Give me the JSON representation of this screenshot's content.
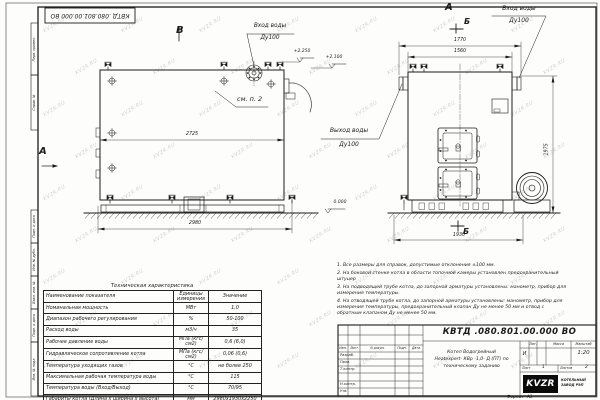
{
  "watermark": {
    "text": "KVZR.RU"
  },
  "corner_stamp": {
    "text": "КВТД .080.801.00.000  ВО"
  },
  "margin_labels": [
    "Перв. примен.",
    "Справ. №",
    "Подп. и дата",
    "Инв. № дубл.",
    "Взам. инв. №",
    "Подп. и дата",
    "Инв. № подл."
  ],
  "drawing": {
    "view_labels": {
      "v_side": "В",
      "v_front": "А",
      "section_top": "Б",
      "section_bottom": "Б",
      "arrow_left": "А"
    },
    "labels": {
      "inlet_left_1": "Вход воды",
      "inlet_left_2": "Ду100",
      "inlet_right_1": "Вход воды",
      "inlet_right_2": "Ду100",
      "outlet_1": "Выход воды",
      "outlet_2": "Ду100",
      "see_note": "см. п. 2"
    },
    "dimensions": {
      "side_body_length": "2725",
      "side_overall_length": "2980",
      "front_overall_width": "1770",
      "front_body_width": "1560",
      "front_height": "1975",
      "front_base_width": "1930"
    },
    "elevations": {
      "top": "+2.250",
      "mid": "+2.100",
      "ground": "0.000"
    }
  },
  "notes": {
    "items": [
      "1. Все размеры для справок, допустимые отклонения ±100 мм.",
      "2. На боковой стенке котла в области топочной камеры установлен предохранительный штуцер",
      "3. На подводящей трубе котла, до запорной арматуры установлены: манометр, прибор для измерения температуры.",
      "4. На отводящей трубе котла, до запорной арматуры установлены: манометр, прибор для измерения температуры, предохранительный клапан Ду не менее 50 мм и отвод с обратным клапаном Ду не менее 50 мм."
    ]
  },
  "tech_table": {
    "title": "Техническая характеристика",
    "headers": {
      "name": "Наименование показателя",
      "units": "Единицы\nизмерения",
      "value": "Значение"
    },
    "rows": [
      {
        "name": "Номинальная мощность",
        "units": "МВт",
        "value": "1,0"
      },
      {
        "name": "Диапазон рабочего регулирования",
        "units": "%",
        "value": "50-100"
      },
      {
        "name": "Расход воды",
        "units": "м3/ч",
        "value": "35"
      },
      {
        "name": "Рабочее давление воды",
        "units": "МПа (кгс/см2)",
        "value": "0,6 (6,0)"
      },
      {
        "name": "Гидравлическое сопротивление котла",
        "units": "МПа (кгс/см2)",
        "value": "0,06 (0,6)"
      },
      {
        "name": "Температура уходящих газов",
        "units": "°С",
        "value": "не более 250"
      },
      {
        "name": "Максимальная рабочая температура воды",
        "units": "°С",
        "value": "115"
      },
      {
        "name": "Температура воды (Вход/Выход)",
        "units": "°С",
        "value": "70/95"
      },
      {
        "name": "Габариты котла (Длина х ширина х высота)",
        "units": "мм",
        "value": "2980х1930х2250"
      }
    ]
  },
  "title_block": {
    "doc_number": "КВТД .080.801.00.000  ВО",
    "name_line1": "Котел Водогрейный",
    "name_line2": "Heatexpert- КВр -1,0- Д (ПТ) по",
    "name_line3": "техническому заданию",
    "col_izm": "Изм.",
    "col_list": "Лист",
    "col_doc": "N докум.",
    "col_podp": "Подп.",
    "col_data": "Дата",
    "roles": [
      "Разраб.",
      "Пров.",
      "Т.контр.",
      "Н.контр.",
      "Утв."
    ],
    "lit_label": "Лит.",
    "mass_label": "Масса",
    "scale_label": "Масштаб",
    "lit_value": "И",
    "scale_value": "1:20",
    "sheet_label": "Лист",
    "sheet_value": "1",
    "sheets_label": "Листов",
    "sheets_value": "2",
    "logo_text": "KVZR",
    "company_line1": "КОТЕЛЬНЫЙ",
    "company_line2": "ЗАВОД РЭП",
    "format_label": "Формат",
    "format_value": "А3"
  }
}
